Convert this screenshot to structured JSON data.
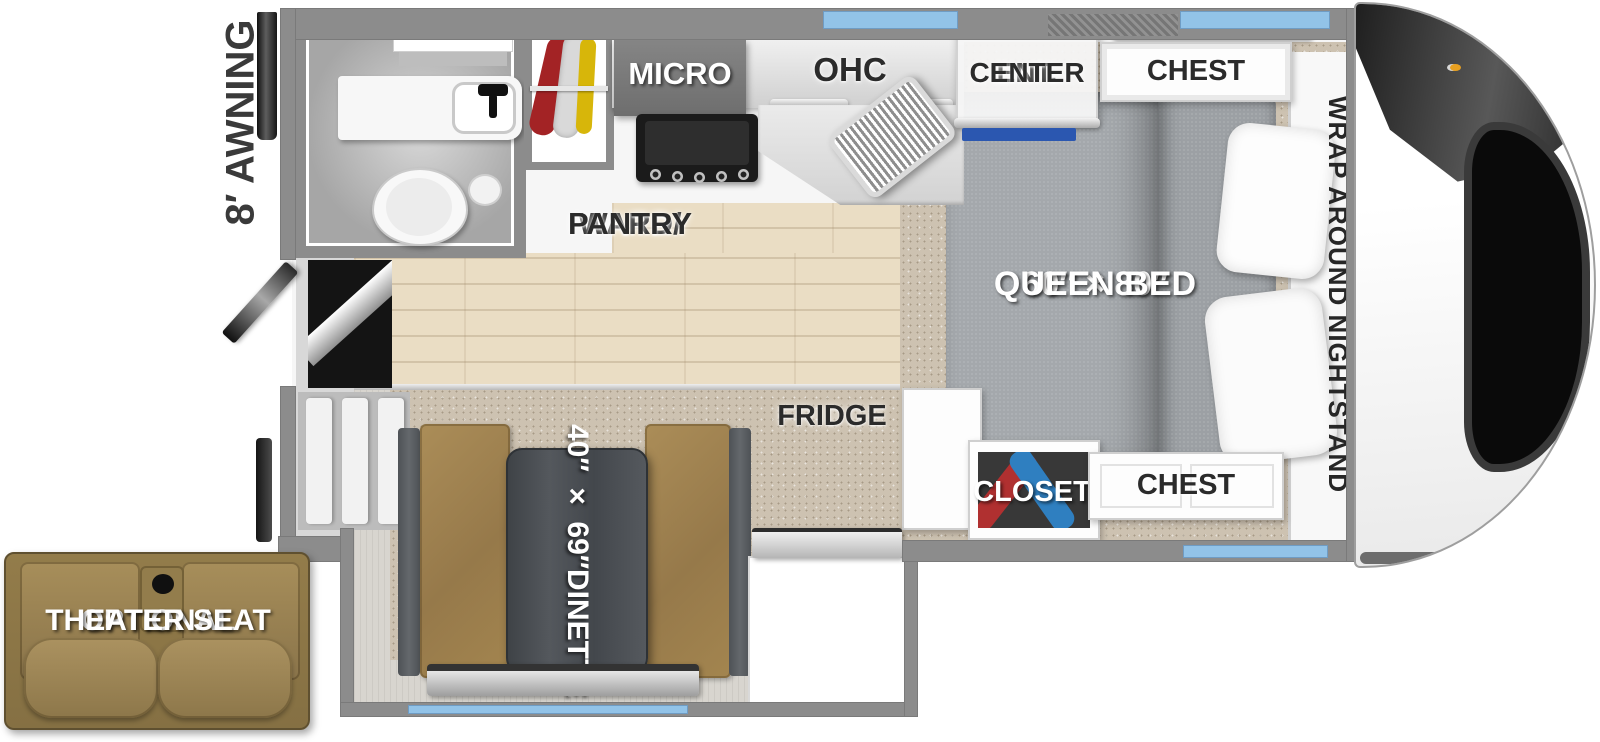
{
  "diagram": {
    "type": "rv-truck-camper-floor-plan",
    "labels": {
      "awning": "8′ AWNING",
      "micro": "MICRO",
      "ohc": "OHC",
      "ent1": "ENT.",
      "ent2": "CENTER",
      "chest_top": "CHEST",
      "wrap": "WRAP AROUND NIGHTSTAND",
      "ward1": "WARD/",
      "ward2": "PANTRY",
      "bed1": "60″ × 80″",
      "bed2": "QUEEN BED",
      "fridge": "FRIDGE",
      "closet": "CLOSET",
      "chest_bottom": "CHEST",
      "dinette1": "40″ × 69″",
      "dinette2": "DINETTE",
      "theater1": "OPTIONAL",
      "theater2": "THEATER SEAT"
    },
    "colors": {
      "wall": "#8c8c8c",
      "window_blue": "#92c3e8",
      "wood_floor": "#eaddc4",
      "carpet": "#cdc2b1",
      "bed_fabric": "#a4a8ac",
      "pillow": "#fdfdfd",
      "dinette_upholstery": "#a3854f",
      "theater_upholstery": "#97804e",
      "table_wood": "#46494d",
      "tv_blue": "#2b57b0",
      "clothes_red": "#b03030",
      "clothes_blue": "#2f7fc0",
      "clothes_yellow": "#d7b60a",
      "label_dark": "#2b2b2b",
      "label_light": "#ffffff"
    }
  }
}
